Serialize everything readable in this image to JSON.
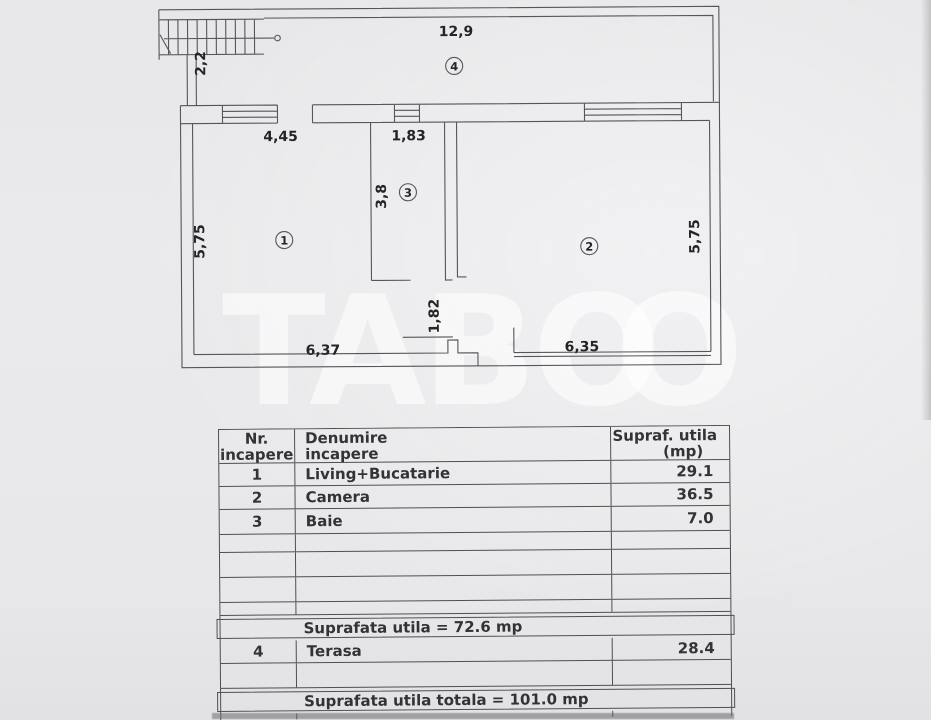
{
  "watermark": {
    "part1": "TABO",
    "part2": "O"
  },
  "plan": {
    "dims": {
      "terrace_width": "12,9",
      "stair_width": "2,2",
      "living_width": "4,45",
      "bath_width": "1,83",
      "bath_depth": "3,8",
      "living_depth": "5,75",
      "camera_depth": "5,75",
      "living_bottom": "6,37",
      "camera_bottom": "6,35",
      "hall_depth": "1,82"
    },
    "room_numbers": {
      "living": "1",
      "camera": "2",
      "bath": "3",
      "terrace": "4"
    }
  },
  "table": {
    "header": {
      "col1_line1": "Nr.",
      "col1_line2": "incapere",
      "col2_line1": "Denumire",
      "col2_line2": "incapere",
      "col3_line1": "Supraf. utila",
      "col3_line2": "(mp)"
    },
    "rows": [
      {
        "nr": "1",
        "name": "Living+Bucatarie",
        "area": "29.1"
      },
      {
        "nr": "2",
        "name": "Camera",
        "area": "36.5"
      },
      {
        "nr": "3",
        "name": "Baie",
        "area": "7.0"
      }
    ],
    "subtotal": "Suprafata utila = 72.6 mp",
    "terasa_row": {
      "nr": "4",
      "name": "Terasa",
      "area": "28.4"
    },
    "total": "Suprafata utila totala = 101.0 mp"
  }
}
